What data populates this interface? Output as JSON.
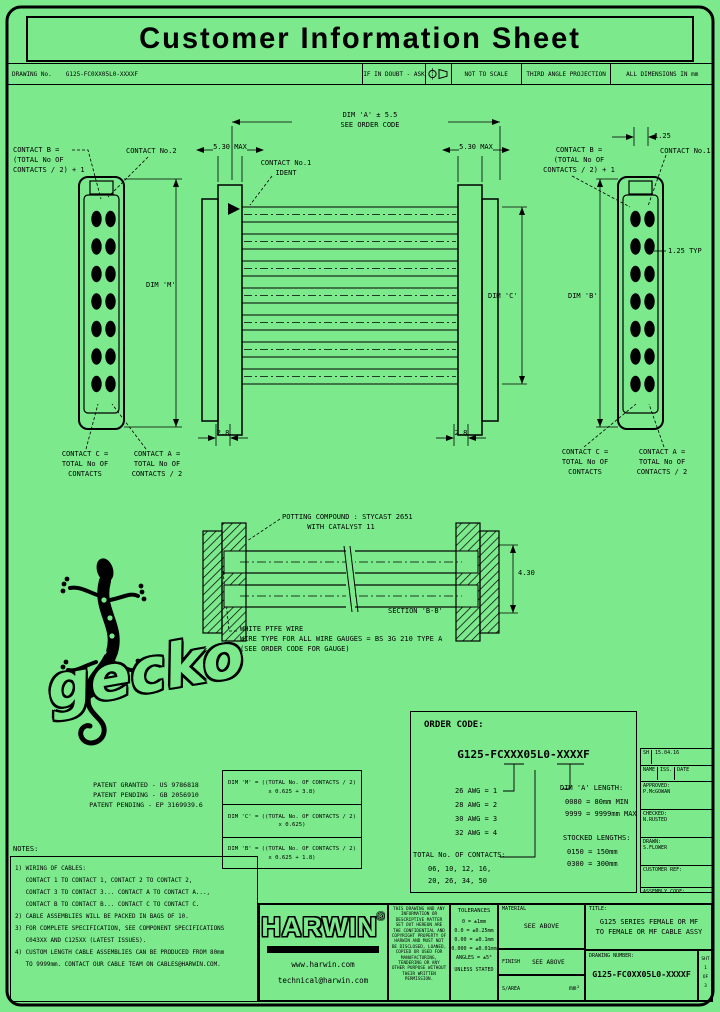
{
  "page": {
    "bg": "#7CE98D",
    "ink": "#000000",
    "title": "Customer Information Sheet"
  },
  "header": {
    "drawing_no_label": "DRAWING No.",
    "drawing_no": "G125-FC0XX05L0-XXXXF",
    "if_in_doubt": "IF IN DOUBT - ASK",
    "projection_icon": "third-angle-projection-symbol",
    "not_to_scale": "NOT TO SCALE",
    "projection": "THIRD ANGLE PROJECTION",
    "dims_in": "ALL DIMENSIONS IN mm"
  },
  "drawing": {
    "contact_b": "CONTACT B =\n(TOTAL No OF\nCONTACTS / 2) + 1",
    "contact_no2": "CONTACT No.2",
    "contact_no1": "CONTACT No.1",
    "contact_no1_ident": "CONTACT No.1\nIDENT",
    "max_left": "5.30 MAX",
    "max_right": "5.30 MAX",
    "dim_a_span": "DIM 'A' ± 5.5\nSEE ORDER CODE",
    "pitch": "1.25",
    "pitch_typ": "1.25 TYP",
    "dim_m": "DIM 'M'",
    "dim_c": "DIM 'C'",
    "dim_b": "DIM 'B'",
    "d28": "2.8",
    "contact_c": "CONTACT C =\nTOTAL No OF\nCONTACTS",
    "contact_a": "CONTACT A =\nTOTAL No OF\nCONTACTS / 2",
    "potting": "POTTING COMPOUND : STYCAST 2651\n      WITH CATALYST 11",
    "wire_note": "WHITE PTFE WIRE\nWIRE TYPE FOR ALL WIRE GAUGES = BS 3G 210 TYPE A\n(SEE ORDER CODE FOR GAUGE)",
    "section_label": "SECTION 'B-B'",
    "d430": "4.30"
  },
  "logo": {
    "wordmark": "gecko"
  },
  "patents": "PATENT GRANTED - US 9786818\nPATENT PENDING - GB 2056910\nPATENT PENDING - EP 3169939.6",
  "dim_table": {
    "r1": "DIM 'M' = ((TOTAL No. OF CONTACTS / 2)\nx 0.625 + 3.8)",
    "r2": "DIM 'C' = ((TOTAL No. OF CONTACTS / 2)\nx 0.625)",
    "r3": "DIM 'B' = ((TOTAL No. OF CONTACTS / 2)\nx 0.625 + 1.8)"
  },
  "order_code": {
    "heading": "ORDER CODE:",
    "code": "G125-FCXXX05L0-XXXXF",
    "gauges": "26 AWG = 1\n28 AWG = 2\n30 AWG = 3\n32 AWG = 4",
    "contacts_label": "TOTAL No. OF CONTACTS:",
    "contacts_values": "06, 10, 12, 16,\n20, 26, 34, 50",
    "dim_a_heading": "DIM 'A' LENGTH:",
    "dim_a_values": "0080 = 80mm MIN\n9999 = 9999mm MAX",
    "stocked_heading": "STOCKED LENGTHS:",
    "stocked_values": "0150 = 150mm\n0300 = 300mm"
  },
  "revisions": {
    "sh": "SH",
    "date1": "15.04.16",
    "name": "NAME",
    "iss": "ISS.",
    "date_label": "DATE",
    "approved": "APPROVED:\nP.McGOWAN",
    "checked": "CHECKED:\nN.RUSTED",
    "drawn": "DRAWN:\nS.FLOWER",
    "customer_ref": "CUSTOMER REF:",
    "assembly_code": "ASSEMBLY CODE:"
  },
  "notes": {
    "heading": "NOTES:",
    "body": "1) WIRING OF CABLES:\n   CONTACT 1 TO CONTACT 1, CONTACT 2 TO CONTACT 2,\n   CONTACT 3 TO CONTACT 3... CONTACT A TO CONTACT A...,\n   CONTACT B TO CONTACT B... CONTACT C TO CONTACT C.\n2) CABLE ASSEMBLIES WILL BE PACKED IN BAGS OF 10.\n3) FOR COMPLETE SPECIFICATION, SEE COMPONENT SPECIFICATIONS\n   C043XX AND C125XX (LATEST ISSUES).\n4) CUSTOM LENGTH CABLE ASSEMBLIES CAN BE PRODUCED FROM 80mm\n   TO 9999mm. CONTACT OUR CABLE TEAM ON CABLES@HARWIN.COM."
  },
  "titleblock": {
    "brand": "HARWIN",
    "brand_reg": "®",
    "url": "www.harwin.com",
    "email": "technical@harwin.com",
    "legal": "THIS DRAWING AND ANY INFORMATION OR DESCRIPTIVE MATTER SET OUT HEREON ARE THE CONFIDENTIAL AND COPYRIGHT PROPERTY OF HARWIN AND MUST NOT BE DISCLOSED, LOANED, COPIED OR USED FOR MANUFACTURING, TENDERING OR ANY OTHER PURPOSE WITHOUT THEIR WRITTEN PERMISSION.",
    "tolerances_heading": "TOLERANCES",
    "tolerances": "0 = ±1mm\n0.0 = ±0.25mm\n0.00 = ±0.1mm\n0.000 = ±0.01mm\nANGLES = ±5°",
    "unless": "UNLESS STATED",
    "material_label": "MATERIAL",
    "material_value": "SEE ABOVE",
    "finish_label": "FINISH",
    "finish_value": "SEE ABOVE",
    "sarea_label": "S/AREA",
    "sarea_unit": "mm²",
    "title_label": "TITLE:",
    "title_value": "G125 SERIES FEMALE OR MF\nTO FEMALE OR MF CABLE ASSY",
    "dwg_label": "DRAWING NUMBER:",
    "dwg_value": "G125-FC0XX05L0-XXXXF",
    "sheet": "SHT\n1\nOF\n3"
  }
}
